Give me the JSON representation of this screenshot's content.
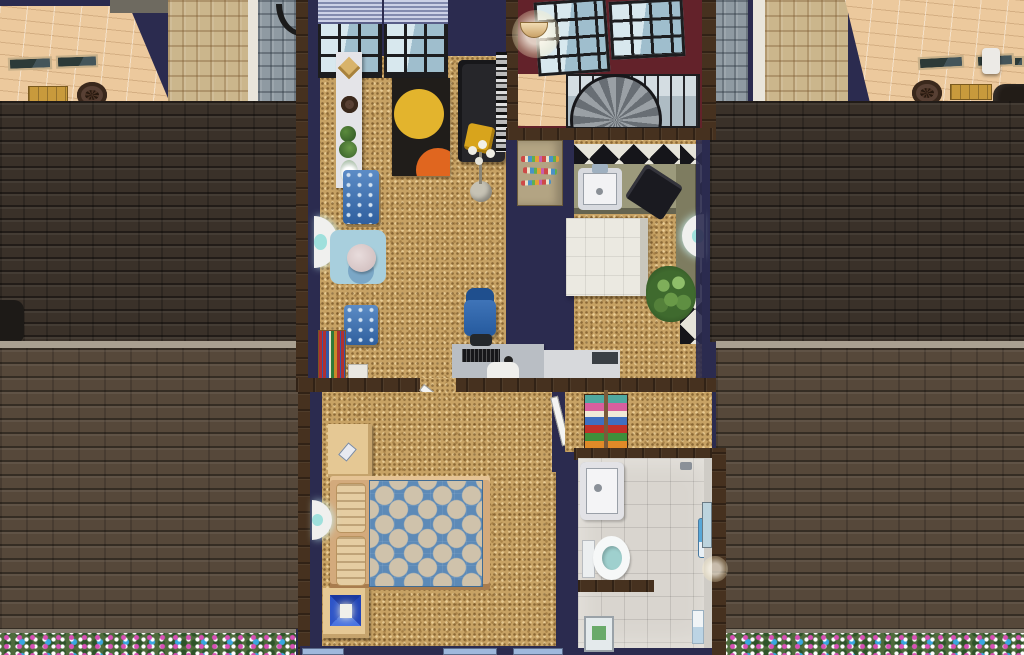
{
  "app": {
    "name": "The Sims 2",
    "view": "top-down floor-plan camera of an upstairs apartment, walls-cutaway build/live view",
    "scene": "row-house upper floor flanked by shingled roofs, neighbor roof terraces above and flower hedges below"
  },
  "palette": {
    "roof_dark": "#3a3129",
    "roof_light": "#56483a",
    "gutter": "#a9a091",
    "gutter2": "#837b6d",
    "terrace": "#ecc99d",
    "stone_tan": "#cbb68c",
    "stone_blue": "#8f9aa2",
    "pillar": "#e9e5db",
    "wall_navy": "#2b2b4f",
    "trim_wood": "#46311f",
    "floor_cork": "#c7a264",
    "maroon": "#63222a",
    "checker_dark": "#15151a",
    "checker_light": "#e6e4da",
    "bath_tile": "#d9d5cf",
    "island": "#ebe9e1",
    "counter_olive": "#9c9a7c",
    "counter_dark": "#7e7c60",
    "bed_blue": "#5d8ab7",
    "bed_dot": "#cfc2ab",
    "chair_blue": "#3e6fae",
    "rug_black": "#201d1a",
    "rug_yellow": "#e3b42d",
    "rug_orange": "#e0661f",
    "rug_lblue": "#a8cfdd",
    "flower_green": "#4e6b3c",
    "sofa": "#26262a",
    "fridge": "#b3a483",
    "wood_furn": "#d3aa7c",
    "nightstand": "#e5c894"
  },
  "exterior": {
    "left_neighbor": {
      "label": "Left neighbor roof terrace",
      "objects": [
        "skylight",
        "skylight",
        "wooden bench",
        "gear ornament",
        "tan stone wall",
        "blue-gray stone wall",
        "white pillar"
      ]
    },
    "right_neighbor": {
      "label": "Right neighbor roof terrace",
      "objects": [
        "skylight",
        "skylight",
        "skylight",
        "white roof lamp",
        "gear ornament",
        "wooden bench",
        "dark chimney"
      ]
    },
    "roof": {
      "label": "Brown asphalt shingle roof",
      "upper_slope": "dark shingles",
      "lower_slope": "lighter shingles",
      "gutter": "pale stone ledge"
    },
    "garden": {
      "label": "Flower hedge strip",
      "colors": [
        "pink",
        "white",
        "blue",
        "green"
      ]
    }
  },
  "rooms": {
    "living_room": {
      "label": "Living room",
      "floor": "cork",
      "objects": [
        "window with lavender blinds",
        "window with lavender blinds",
        "white console shelf",
        "hand sculpture",
        "gear collectible",
        "potted plants",
        "flower vase",
        "black area rug with yellow and orange circles",
        "charcoal chaise sofa",
        "mustard throw pillow",
        "flower-bulb floor lamp",
        "blue dining chair",
        "blue dining chair",
        "round dining table on light-blue rug",
        "wall sconce",
        "small bookshelf",
        "white floor unit",
        "striped wall hanging"
      ]
    },
    "stairwell": {
      "label": "Stairwell landing",
      "walls": "maroon",
      "objects": [
        "spiral staircase",
        "tall black-frame windows",
        "lower window band",
        "half-moon wall lamp",
        "tan tile landing"
      ]
    },
    "kitchen": {
      "label": "Kitchen",
      "floor": "cork with black-and-white checker border",
      "objects": [
        "refrigerator covered in magnets",
        "olive counter with white sink",
        "black dish rack",
        "dark olive side counter",
        "white tile island",
        "potted shrub",
        "wall sconce"
      ]
    },
    "office_nook": {
      "label": "Desk nook",
      "objects": [
        "gray computer desk",
        "black keyboard",
        "mouse",
        "white printer/paper",
        "dark monitor",
        "blue office chair",
        "open white door"
      ]
    },
    "bedroom": {
      "label": "Bedroom",
      "floor": "cork",
      "objects": [
        "double bed with blue polka-dot duvet",
        "two ribbed pillows",
        "nightstand with cell phone",
        "nightstand with blue pyramid lamp",
        "wall sconce",
        "open white door to closet",
        "three windows on south wall"
      ]
    },
    "closet": {
      "label": "Linen closet",
      "objects": [
        "towel shelf stacked with colorful towels"
      ]
    },
    "bathroom": {
      "label": "Bathroom",
      "floor": "gray tile",
      "objects": [
        "white pedestal sink",
        "toilet with open lid",
        "shower stall with frosted door",
        "blue towel ring",
        "white towel",
        "wall window",
        "exterior wall lamp"
      ]
    }
  }
}
